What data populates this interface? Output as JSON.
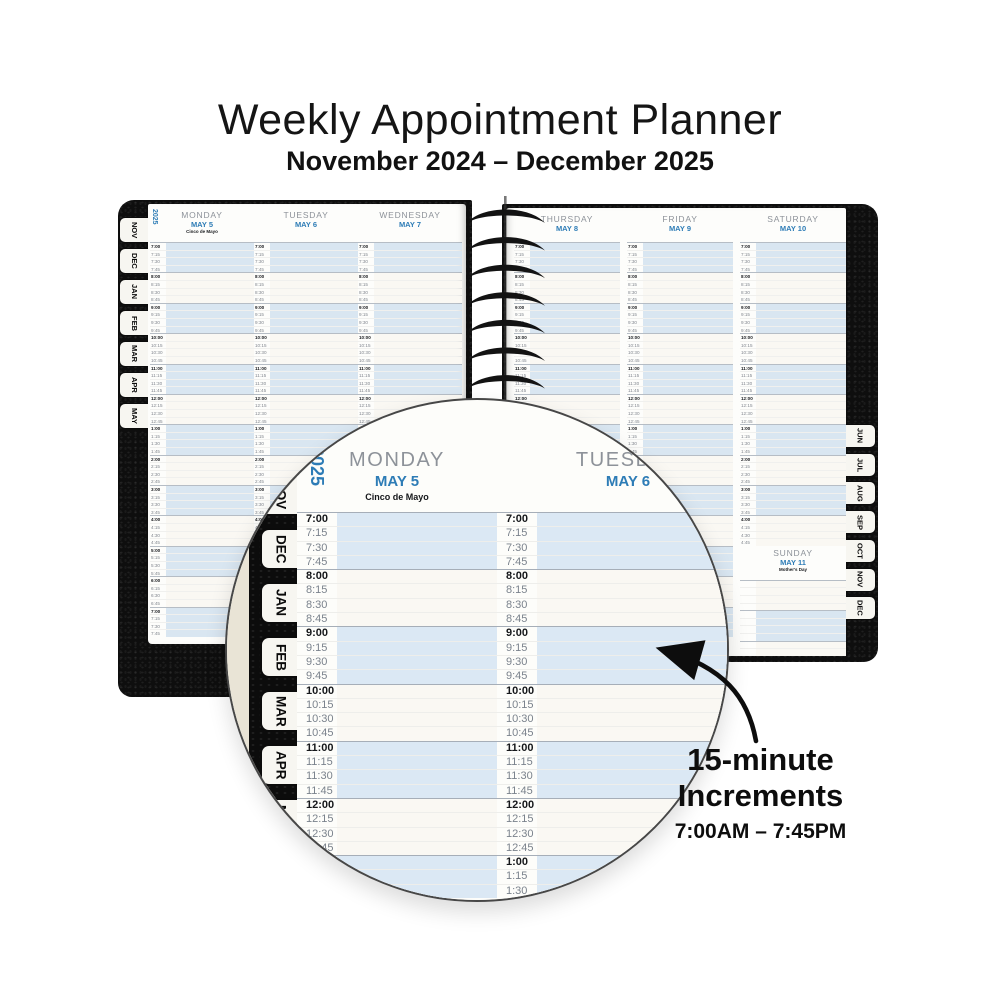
{
  "title": "Weekly Appointment Planner",
  "subtitle": "November 2024 – December 2025",
  "planner": {
    "year_label": "2025",
    "left_tabs": [
      "NOV",
      "DEC",
      "JAN",
      "FEB",
      "MAR",
      "APR",
      "MAY"
    ],
    "right_tabs": [
      "JUN",
      "JUL",
      "AUG",
      "SEP",
      "OCT",
      "NOV",
      "DEC"
    ],
    "left_page_days": [
      {
        "name": "MONDAY",
        "date": "MAY 5",
        "holiday": "Cinco de Mayo"
      },
      {
        "name": "TUESDAY",
        "date": "MAY 6",
        "holiday": ""
      },
      {
        "name": "WEDNESDAY",
        "date": "MAY 7",
        "holiday": ""
      }
    ],
    "right_page_days": [
      {
        "name": "THURSDAY",
        "date": "MAY 8",
        "holiday": ""
      },
      {
        "name": "FRIDAY",
        "date": "MAY 9",
        "holiday": ""
      },
      {
        "name": "SATURDAY",
        "date": "MAY 10",
        "holiday": ""
      }
    ],
    "sunday": {
      "name": "SUNDAY",
      "date": "MAY 11",
      "holiday": "Mother's Day"
    },
    "time_slots": [
      "7:00",
      "7:15",
      "7:30",
      "7:45",
      "8:00",
      "8:15",
      "8:30",
      "8:45",
      "9:00",
      "9:15",
      "9:30",
      "9:45",
      "10:00",
      "10:15",
      "10:30",
      "10:45",
      "11:00",
      "11:15",
      "11:30",
      "11:45",
      "12:00",
      "12:15",
      "12:30",
      "12:45",
      "1:00",
      "1:15",
      "1:30",
      "1:45",
      "2:00",
      "2:15",
      "2:30",
      "2:45",
      "3:00",
      "3:15",
      "3:30",
      "3:45",
      "4:00",
      "4:15",
      "4:30",
      "4:45",
      "5:00",
      "5:15",
      "5:30",
      "5:45",
      "6:00",
      "6:15",
      "6:30",
      "6:45",
      "7:00",
      "7:15",
      "7:30",
      "7:45"
    ],
    "saturday_slot_count": 40,
    "sunday_blank_rows": 10
  },
  "magnifier": {
    "year_label": "2025",
    "tabs": [
      "NOV",
      "DEC",
      "JAN",
      "FEB",
      "MAR",
      "APR",
      "MAY"
    ],
    "days": [
      {
        "name": "MONDAY",
        "date": "MAY 5",
        "holiday": "Cinco de Mayo"
      },
      {
        "name": "TUESDAY",
        "date": "MAY 6",
        "holiday": ""
      }
    ],
    "visible_slot_count": 27
  },
  "annotation": {
    "line1": "15-minute",
    "line2": "Increments",
    "line3": "7:00AM – 7:45PM"
  },
  "colors": {
    "accent": "#2d7cb6",
    "band_blue": "#d9e6f1",
    "mag_blue": "#dbe8f4",
    "band_cream": "#faf8f3",
    "day_gray": "#8d9299",
    "beige": "#e9e4d6"
  }
}
